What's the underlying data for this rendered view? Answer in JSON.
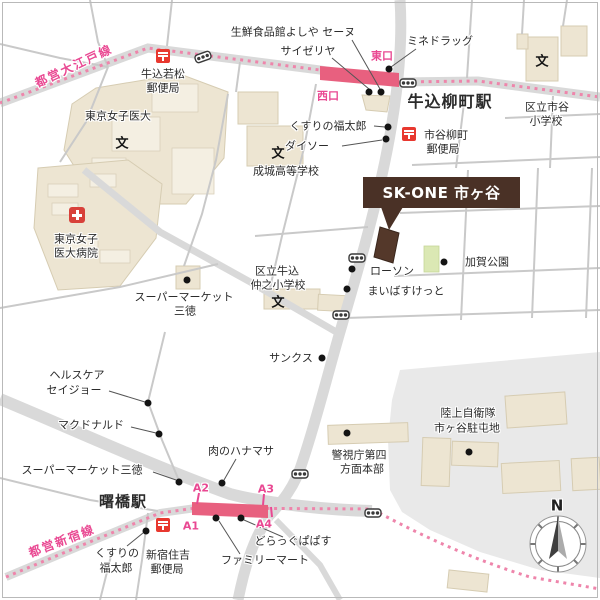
{
  "property": {
    "name": "SK-ONE 市ヶ谷"
  },
  "lines": {
    "oedo": "都営大江戸線",
    "shinjuku": "都営新宿線"
  },
  "stations": {
    "ushigome_yanagicho": "牛込柳町駅",
    "akebonobashi": "曙橋駅"
  },
  "exits": {
    "east": "東口",
    "west": "西口",
    "a1": "A1",
    "a2": "A2",
    "a3": "A3",
    "a4": "A4"
  },
  "marks": {
    "school": "文",
    "post": "〒",
    "north": "N"
  },
  "pois": {
    "yoshiya": "生鮮食品館よしや セーヌ",
    "saizeriya": "サイゼリヤ",
    "minedrug": "ミネドラッグ",
    "wakamatsu_po": [
      "牛込若松",
      "郵便局"
    ],
    "womens_univ": "東京女子医大",
    "ichigaya_elem": [
      "区立市谷",
      "小学校"
    ],
    "fukutaro_north": "くすりの福太郎",
    "daiso": "ダイソー",
    "yanagicho_po": [
      "市谷柳町",
      "郵便局"
    ],
    "seijo_high": "成城高等学校",
    "womens_hosp": [
      "東京女子",
      "医大病院"
    ],
    "lawson": "ローソン",
    "kaga_park": "加賀公園",
    "maibasuketto": "まいばすけっと",
    "nakano_elem": [
      "区立牛込",
      "仲之小学校"
    ],
    "santoku_north": [
      "スーパーマーケット",
      "三徳"
    ],
    "sunkus": "サンクス",
    "seijoh": [
      "ヘルスケア",
      "セイジョー"
    ],
    "mcdonalds": "マクドナルド",
    "santoku_south": "スーパーマーケット三徳",
    "hanamasa": "肉のハナマサ",
    "police_hq": [
      "警視庁第四",
      "方面本部"
    ],
    "jsdf": [
      "陸上自衛隊",
      "市ヶ谷駐屯地"
    ],
    "papasu": "どらっぐぱぱす",
    "familymart": "ファミリーマート",
    "fukutaro_south": [
      "くすりの",
      "福太郎"
    ],
    "sumiyoshi_po": [
      "新宿住吉",
      "郵便局"
    ]
  },
  "colors": {
    "rail_pink": "#ee85ab",
    "station_bar": "#e8607f",
    "pink_text": "#e94892",
    "brand_brown": "#4a3126",
    "road": "#d9d9d9",
    "building": "#ede5d2",
    "park_green": "#dbe8b4",
    "post_red": "#e8382f",
    "hospital_red": "#d8413a"
  }
}
